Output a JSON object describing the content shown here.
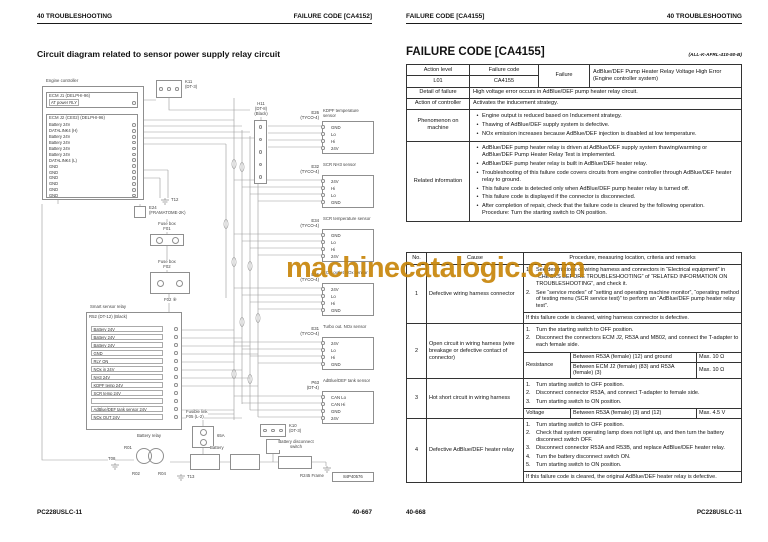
{
  "watermark": {
    "text": "machinecatalogic.com",
    "color": "#c8860a"
  },
  "left_page": {
    "header_left": "40 TROUBLESHOOTING",
    "header_right": "FAILURE CODE [CA4152]",
    "title": "Circuit diagram related to sensor power supply relay circuit",
    "footer_left": "PC228USLC-11",
    "footer_right": "40-667",
    "diagram": {
      "drawing_id": "84P40576",
      "engine_controller_label": "Engine controller",
      "ecm_j1": {
        "label": "ECM J1 (DELPHI-96)",
        "pin": "AT power RLY"
      },
      "ecm_j2": {
        "label": "ECM J2 (CE02) (DELPHI-96)",
        "pins": [
          "Battery 24V",
          "DATALINK4 (H)",
          "Battery 24V",
          "Battery 24V",
          "Battery 24V",
          "Battery 24V",
          "DATALINK4 (L)",
          "GND",
          "GND",
          "GND",
          "GND",
          "GND",
          "GND"
        ]
      },
      "k11": {
        "id": "K11",
        "type": "(DT-3)"
      },
      "h11": {
        "id": "H11",
        "type": "(DT-8)",
        "color": "(Black)"
      },
      "e24": {
        "id": "E24",
        "type": "(FRAMATOME-2K)"
      },
      "fuse_box1": {
        "label": "Fuse box",
        "id": "F01"
      },
      "fuse_box2": {
        "label": "Fuse box",
        "id": "F02"
      },
      "f02_tag": "F02 ⑧",
      "grounds": {
        "t12": "T12",
        "t13": "T13",
        "t08": "T08",
        "frame": "R245 Frame"
      },
      "sensors": [
        {
          "id": "E26",
          "type": "(TYCO-4)",
          "name": "KDPF temperature sensor",
          "pins": [
            "GND",
            "Lo",
            "Hi",
            "24V"
          ]
        },
        {
          "id": "E32",
          "type": "(TYCO-4)",
          "name": "SCR NH3 sensor",
          "pins": [
            "24V",
            "Hi",
            "Lo",
            "GND"
          ]
        },
        {
          "id": "E34",
          "type": "(TYCO-4)",
          "name": "SCR temperature sensor",
          "pins": [
            "GND",
            "Lo",
            "Hi",
            "24V"
          ]
        },
        {
          "id": "E36",
          "type": "(TYCO-4)",
          "name": "SCR outlet NOx sensor",
          "pins": [
            "24V",
            "Lo",
            "Hi",
            "GND"
          ]
        },
        {
          "id": "E31",
          "type": "(TYCO-4)",
          "name": "Turbo out. NOx sensor",
          "pins": [
            "24V",
            "Lo",
            "Hi",
            "GND"
          ]
        },
        {
          "id": "P63",
          "type": "(DT-4)",
          "name": "AdBlue/DEF tank sensor",
          "pins": [
            "CAN Lo",
            "CAN Hi",
            "GND",
            "24V"
          ]
        }
      ],
      "smart_relay": {
        "label": "Smart sensor relay",
        "sub_label": "R52 (DT-12) (Black)",
        "pins": [
          "Battery 24V",
          "Battery 24V",
          "Battery 24V",
          "GND",
          "RLY ON",
          "NOx in 24V",
          "NH3 24V",
          "KDPF temp 24V",
          "SCR temp 24V",
          "",
          "AdBlue/DEF tank sensor 24V",
          "NOx OUT 24V"
        ]
      },
      "bottom": {
        "fusible_link_label": "Fusible link",
        "fusible_link_id": "F05 (L-2)",
        "fusible_link_rating": "65A",
        "k10_id": "K10",
        "k10_type": "(DT-3)",
        "battery_relay_label": "Battery relay",
        "r01": "R01",
        "r02": "R02",
        "r04": "R04",
        "battery_label": "Battery",
        "disconnect_switch_label": "Battery disconnect switch"
      }
    }
  },
  "right_page": {
    "header_left": "FAILURE CODE [CA4155]",
    "header_right": "40 TROUBLESHOOTING",
    "section_title": "FAILURE CODE [CA4155]",
    "section_ref": "(ALL-K-AFRL-410-50-B)",
    "footer_left": "40-668",
    "footer_right": "PC228USLC-11",
    "info_table": {
      "action_level_label": "Action level",
      "action_level": "L01",
      "failure_code_label": "Failure code",
      "failure_code": "CA4155",
      "failure_label": "Failure",
      "failure_line1": "AdBlue/DEF Pump Heater Relay Voltage High Error",
      "failure_line2": "(Engine controller system)",
      "detail_label": "Detail of failure",
      "detail_value": "High voltage error occurs in AdBlue/DEF pump heater relay circuit.",
      "action_label": "Action of controller",
      "action_value": "Activates the inducement strategy.",
      "phenomenon_label": "Phenomenon on machine",
      "phenomenon_items": [
        "Engine output is reduced based on Inducement strategy.",
        "Thawing of AdBlue/DEF supply system is defective.",
        "NOx emission increases because AdBlue/DEF injection is disabled at low temperature."
      ],
      "related_label": "Related information",
      "related_items": [
        "AdBlue/DEF pump heater relay is driven at AdBlue/DEF supply system thawing/warming or AdBlue/DEF Pump Heater Relay Test is implemented.",
        "AdBlue/DEF pump heater relay is built in AdBlue/DEF heater relay.",
        "Troubleshooting of this failure code covers circuits from engine controller through AdBlue/DEF heater relay to ground.",
        "This failure code is detected only when AdBlue/DEF pump heater relay is turned off.",
        "This failure code is displayed if the connector is disconnected.",
        "After completion of repair, check that the failure code is cleared by the following operation.\nProcedure: Turn the starting switch to ON position."
      ]
    },
    "cause_table": {
      "headers": {
        "no": "No.",
        "cause": "Cause",
        "procedure": "Procedure, measuring location, criteria and remarks"
      },
      "rows": [
        {
          "no": "1",
          "cause": "Defective wiring harness connector",
          "steps": [
            {
              "n": "1.",
              "text": "See descriptions of wiring harness and connectors in “Electrical equipment” in “CHECKS BEFORE TROUBLESHOOTING” of “RELATED INFORMATION ON TROUBLESHOOTING”, and check it."
            },
            {
              "n": "2.",
              "text": "See “service modes” of “setting and operating machine monitor”, “operating method of testing menu (SCR service test)” to perform an “AdBlue/DEF pump heater relay test”."
            }
          ],
          "footer": "If this failure code is cleared, wiring harness connector is defective."
        },
        {
          "no": "2",
          "cause": "Open circuit in wiring harness (wire breakage or defective contact of connector)",
          "steps": [
            {
              "n": "1.",
              "text": "Turn the starting switch to OFF position."
            },
            {
              "n": "2.",
              "text": "Disconnect the connectors ECM J2, R53A and MB02, and connect the T-adapter to each female side."
            }
          ],
          "measure_label": "Resistance",
          "measure_rows": [
            {
              "desc": "Between R53A (female) (12) and ground",
              "val": "Max. 10 Ω"
            },
            {
              "desc": "Between ECM J2 (female) (83) and R53A (female) (3)",
              "val": "Max. 10 Ω"
            }
          ]
        },
        {
          "no": "3",
          "cause": "Hot short circuit in wiring harness",
          "steps": [
            {
              "n": "1.",
              "text": "Turn starting switch to OFF position."
            },
            {
              "n": "2.",
              "text": "Disconnect connector R53A, and connect T-adapter to female side."
            },
            {
              "n": "3.",
              "text": "Turn starting switch to ON position."
            }
          ],
          "measure_label": "Voltage",
          "measure_rows": [
            {
              "desc": "Between R53A (female) (3) and (12)",
              "val": "Max. 4.5 V"
            }
          ]
        },
        {
          "no": "4",
          "cause": "Defective AdBlue/DEF heater relay",
          "steps": [
            {
              "n": "1.",
              "text": "Turn starting switch to OFF position."
            },
            {
              "n": "2.",
              "text": "Check that system operating lamp does not light up, and then turn the battery disconnect switch OFF."
            },
            {
              "n": "3.",
              "text": "Disconnect connector R53A and R53B, and replace AdBlue/DEF heater relay."
            },
            {
              "n": "4.",
              "text": "Turn the battery disconnect switch ON."
            },
            {
              "n": "5.",
              "text": "Turn starting switch to ON position."
            }
          ],
          "footer": "If this failure code is cleared, the original AdBlue/DEF heater relay is defective."
        }
      ]
    }
  }
}
